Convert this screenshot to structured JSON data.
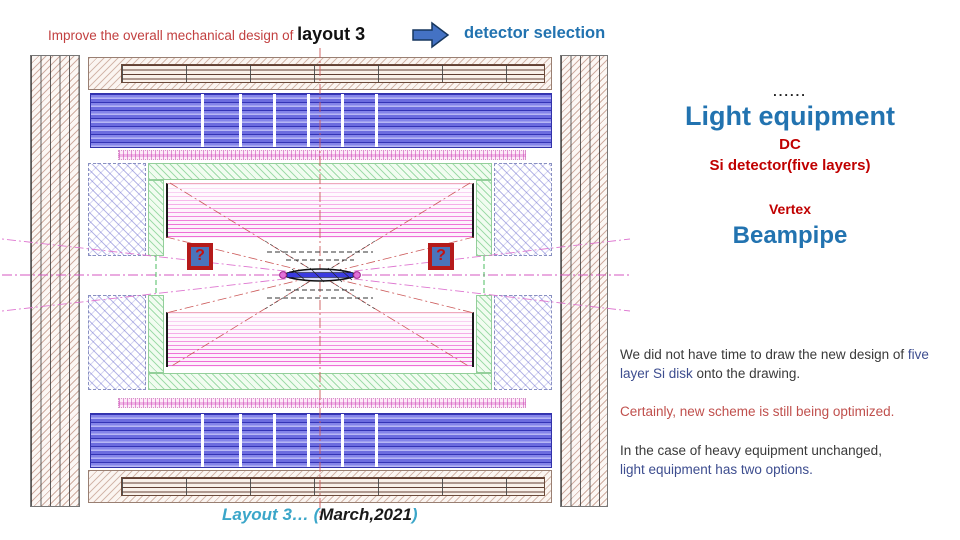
{
  "header": {
    "title_red": "Improve the overall mechanical design of ",
    "title_bold": "layout 3",
    "arrow_icon": "right-arrow",
    "detector_selection": "detector selection"
  },
  "annotations": {
    "dots": "......",
    "light_equipment": "Light equipment",
    "dc": "DC",
    "si_detector": "Si detector(five layers)",
    "vertex": "Vertex",
    "beampipe": "Beampipe",
    "para1_before": "We did not have time to draw the new design of ",
    "para1_highlight": "five layer Si disk",
    "para1_after": " onto the drawing.",
    "para2": "Certainly, new scheme is still being optimized.",
    "para3_line1": "In the case of heavy equipment unchanged,",
    "para3_line2": "light equipment has two options."
  },
  "diagram": {
    "question_mark": "?",
    "caption_teal": "Layout 3… (",
    "caption_black": "March,2021",
    "caption_teal_close": ")"
  },
  "colors": {
    "heading_blue": "#2273b0",
    "label_red": "#c00000",
    "soft_red": "#c0504d",
    "title_red": "#c24040",
    "navy_text": "#3d4d8f",
    "caption_teal": "#3ba6c9",
    "arrow_blue": "#4472c4",
    "barrel_blue": "#6c6cdf",
    "coil_magenta": "#ee6ed6",
    "frame_green": "#3eb656",
    "yoke_brown": "#98543e"
  }
}
